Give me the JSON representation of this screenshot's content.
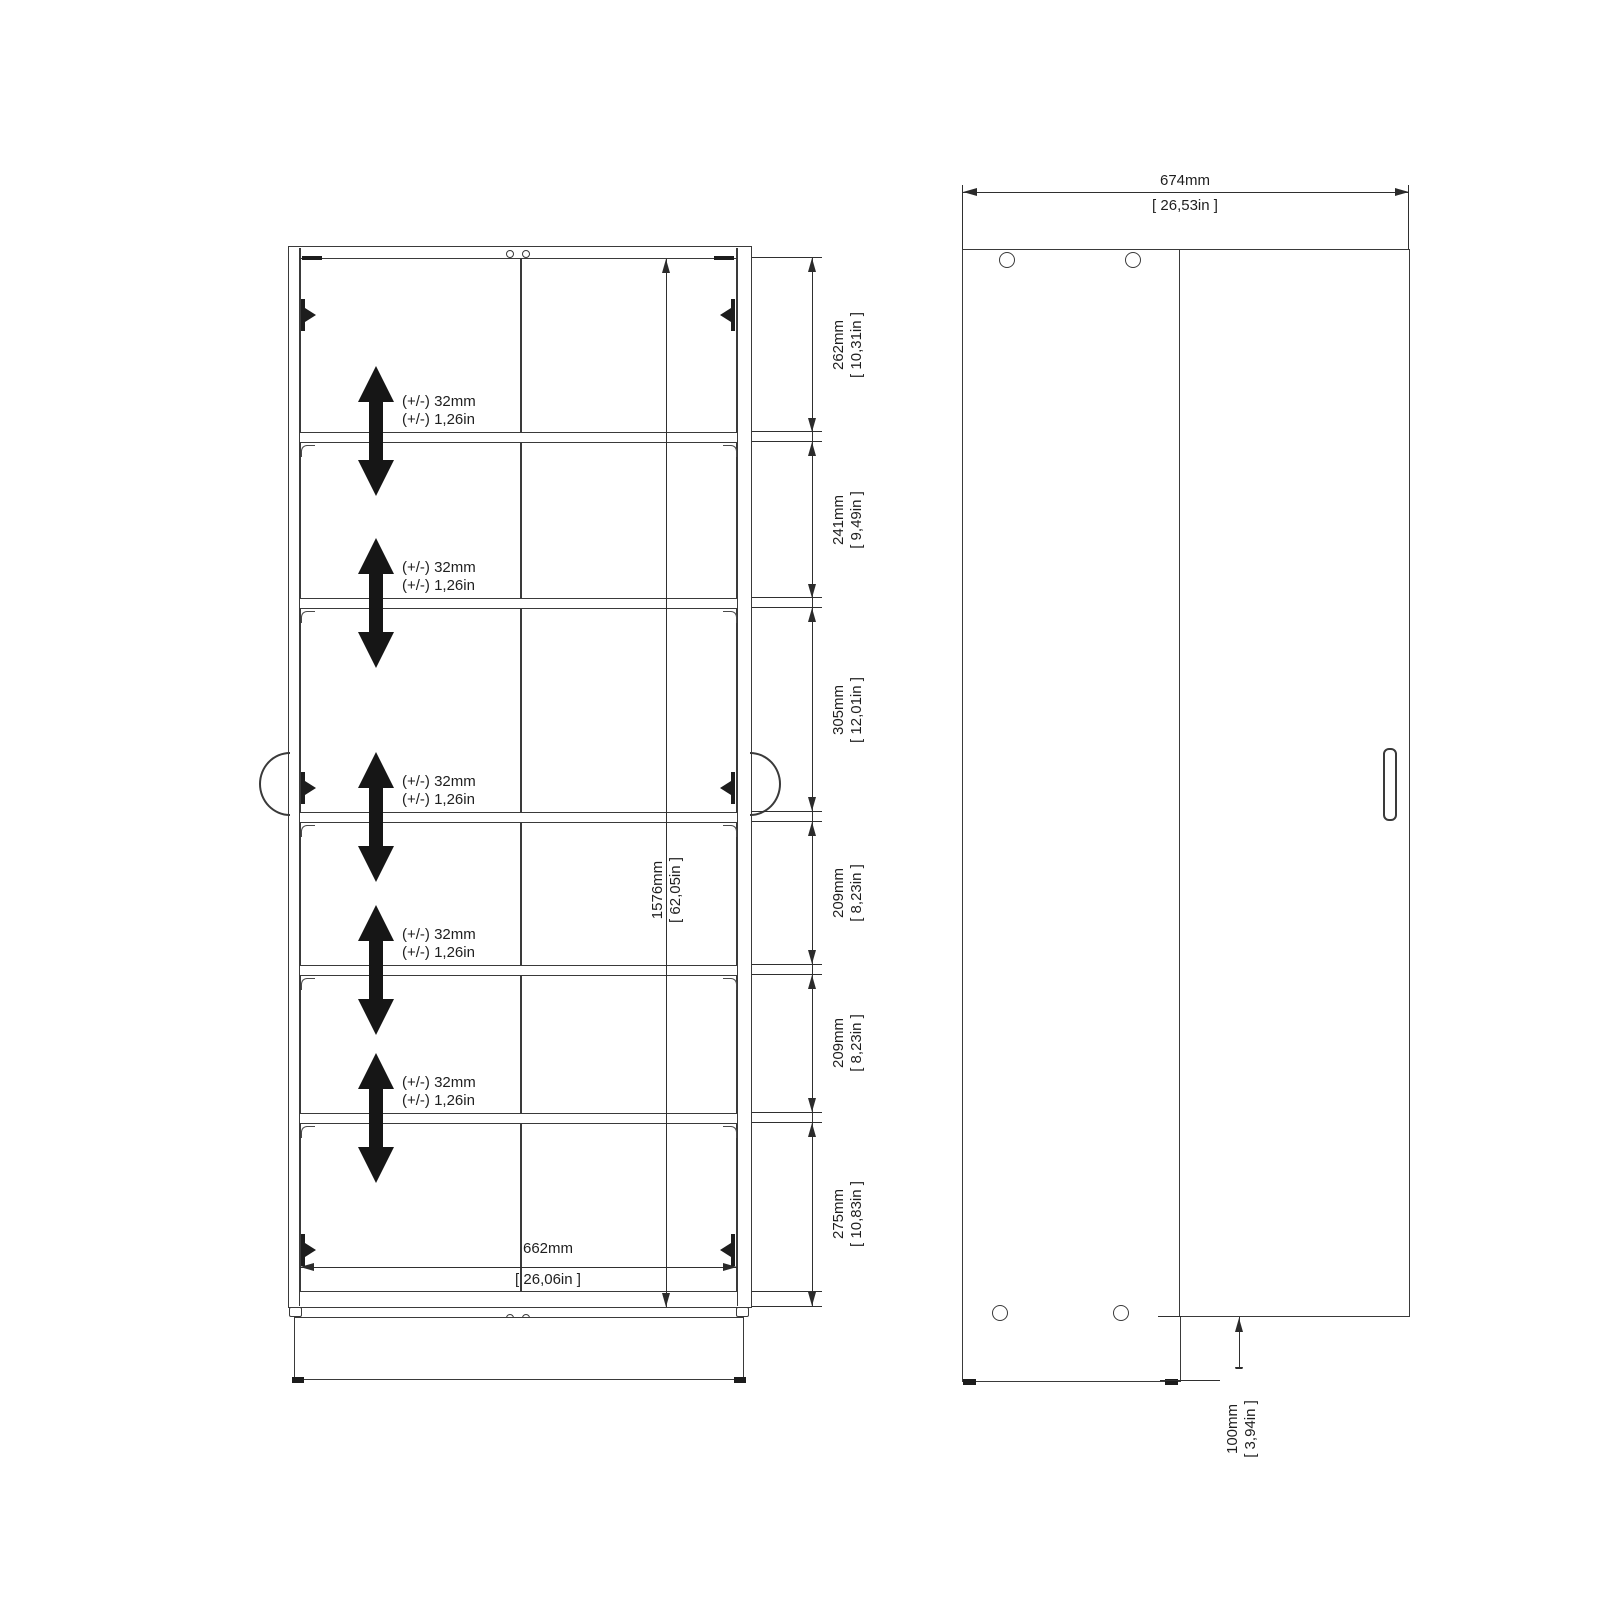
{
  "drawing": {
    "type": "furniture-technical-drawing",
    "views": [
      "front",
      "side"
    ]
  },
  "front_view": {
    "shelf_adjust": {
      "mm": "(+/-) 32mm",
      "inch": "(+/-) 1,26in"
    },
    "sections": [
      {
        "mm": "262mm",
        "inch": "[ 10,31in ]"
      },
      {
        "mm": "241mm",
        "inch": "[ 9,49in ]"
      },
      {
        "mm": "305mm",
        "inch": "[ 12,01in ]"
      },
      {
        "mm": "209mm",
        "inch": "[ 8,23in ]"
      },
      {
        "mm": "209mm",
        "inch": "[ 8,23in ]"
      },
      {
        "mm": "275mm",
        "inch": "[ 10,83in ]"
      }
    ],
    "total_height": {
      "mm": "1576mm",
      "inch": "[ 62,05in ]"
    },
    "inner_width": {
      "mm": "662mm",
      "inch": "[ 26,06in ]"
    }
  },
  "side_view": {
    "width": {
      "mm": "674mm",
      "inch": "[ 26,53in ]"
    },
    "door_floor_clearance": {
      "mm": "100mm",
      "inch": "[ 3,94in ]"
    }
  },
  "icons": {
    "shelf_adjust_arrow": "double-vertical-arrow",
    "hinge_marker": "hinge-cross",
    "handle": "door-handle"
  },
  "colors": {
    "background": "#ffffff",
    "line": "#3a3a3a",
    "arrow": "#161616",
    "text": "#1f1f1f"
  }
}
